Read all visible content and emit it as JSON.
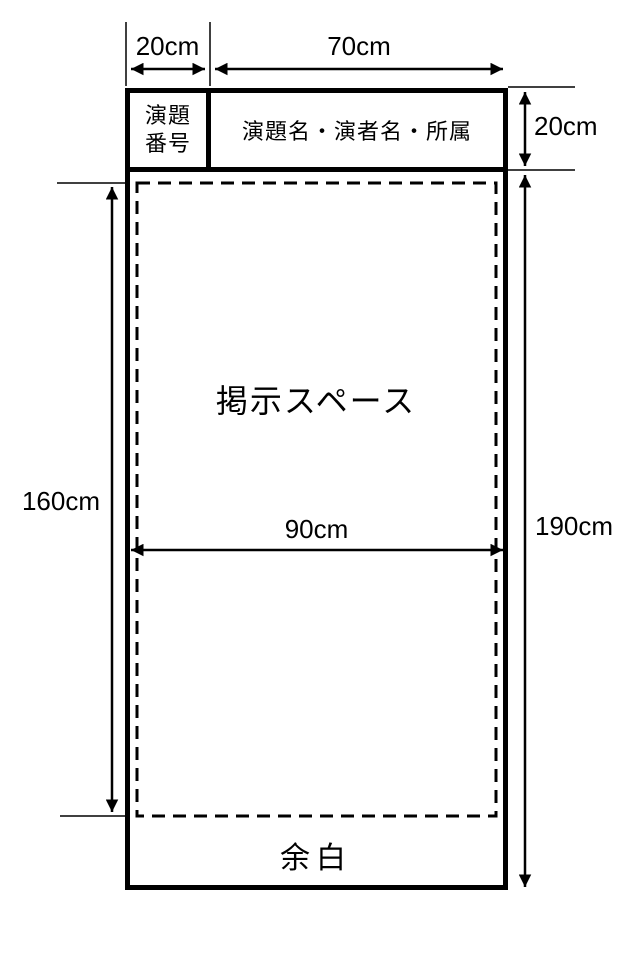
{
  "colors": {
    "background": "#ffffff",
    "ink": "#000000"
  },
  "board": {
    "header": {
      "number_cell_line1": "演題",
      "number_cell_line2": "番号",
      "title_cell": "演題名・演者名・所属"
    },
    "display_space_label": "掲示スペース",
    "margin_label": "余白"
  },
  "dimensions": {
    "number_cell_width": "20cm",
    "title_cell_width": "70cm",
    "header_height": "20cm",
    "display_area_height": "160cm",
    "board_total_height": "190cm",
    "board_total_width": "90cm"
  }
}
